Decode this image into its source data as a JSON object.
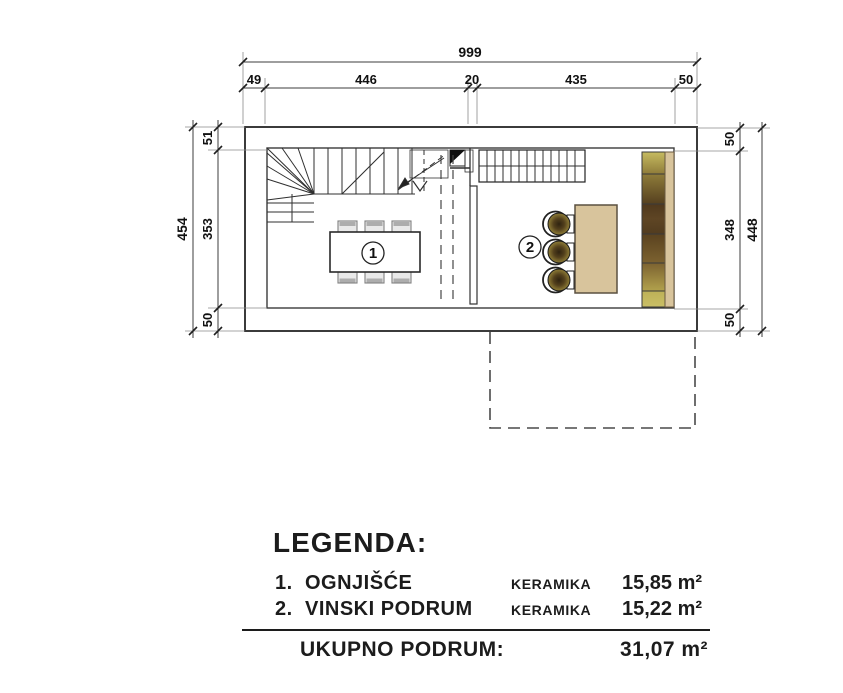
{
  "drawing": {
    "rooms": [
      {
        "number": "1"
      },
      {
        "number": "2"
      }
    ],
    "dimensions": {
      "top": {
        "total": "999",
        "segments": [
          "49",
          "446",
          "20",
          "435",
          "50"
        ]
      },
      "left": {
        "total": "454",
        "segments": [
          "51",
          "353",
          "50"
        ]
      },
      "right": {
        "total": "448",
        "segments": [
          "50",
          "348",
          "50"
        ]
      }
    }
  },
  "legend": {
    "title": "LEGENDA:",
    "items": [
      {
        "num": "1.",
        "name": "OGNJIŠĆE",
        "material": "KERAMIKA",
        "area": "15,85 m²"
      },
      {
        "num": "2.",
        "name": "VINSKI PODRUM",
        "material": "KERAMIKA",
        "area": "15,22 m²"
      }
    ],
    "total_label": "UKUPNO PODRUM:",
    "total_area": "31,07 m²"
  },
  "colors": {
    "line": "#333333",
    "wood_tan": "#d8c49c",
    "shelf_olive": "#b2a24c",
    "shelf_dark_brown": "#553f1f",
    "barrel_dark": "#2f2310",
    "barrel_olive": "#93823a",
    "dashed_outline": "#4a4a4a"
  }
}
